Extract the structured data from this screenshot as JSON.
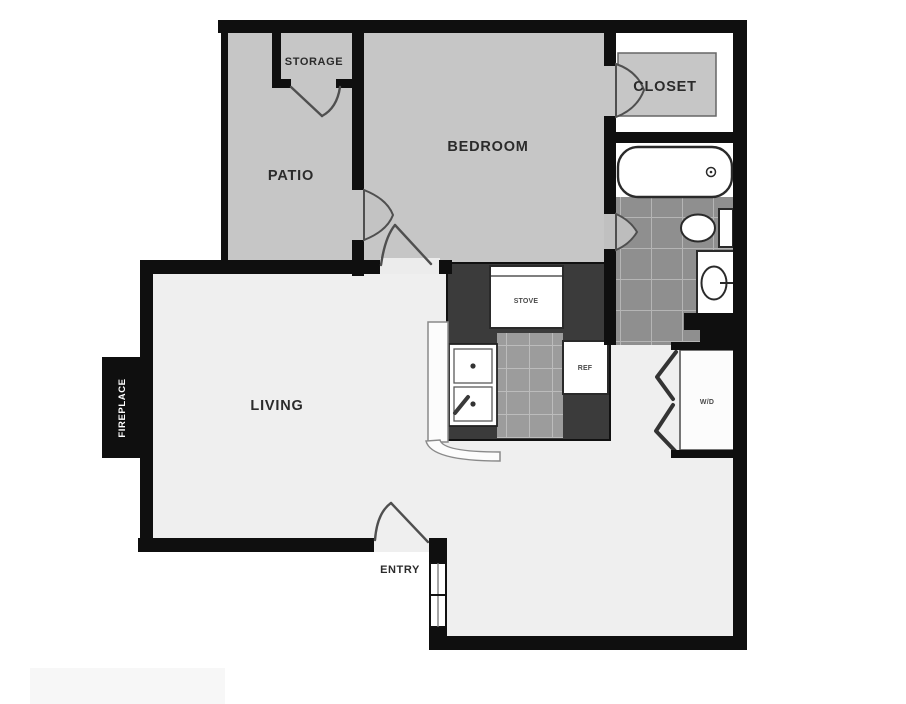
{
  "figure_type": "apartment-floor-plan",
  "palette": {
    "wall": "#0f0f0f",
    "room_gray": "#c6c6c6",
    "floor_light": "#efefef",
    "closet_floor": "#ffffff",
    "tile_bath": "#8f8f8f",
    "tile_kitchen": "#9c9c9c",
    "tile_grout": "#b5b5b5",
    "counter_dark": "#3b3b3b",
    "fixture_white": "#ffffff",
    "label_color": "#2b2b2b",
    "label_inverse": "#ffffff"
  },
  "labels": {
    "storage": "STORAGE",
    "patio": "PATIO",
    "bedroom": "BEDROOM",
    "closet": "CLOSET",
    "living": "LIVING",
    "entry": "ENTRY",
    "fireplace": "FIREPLACE",
    "stove": "STOVE",
    "refrigerator": "REF",
    "washer_dryer": "W/D"
  }
}
